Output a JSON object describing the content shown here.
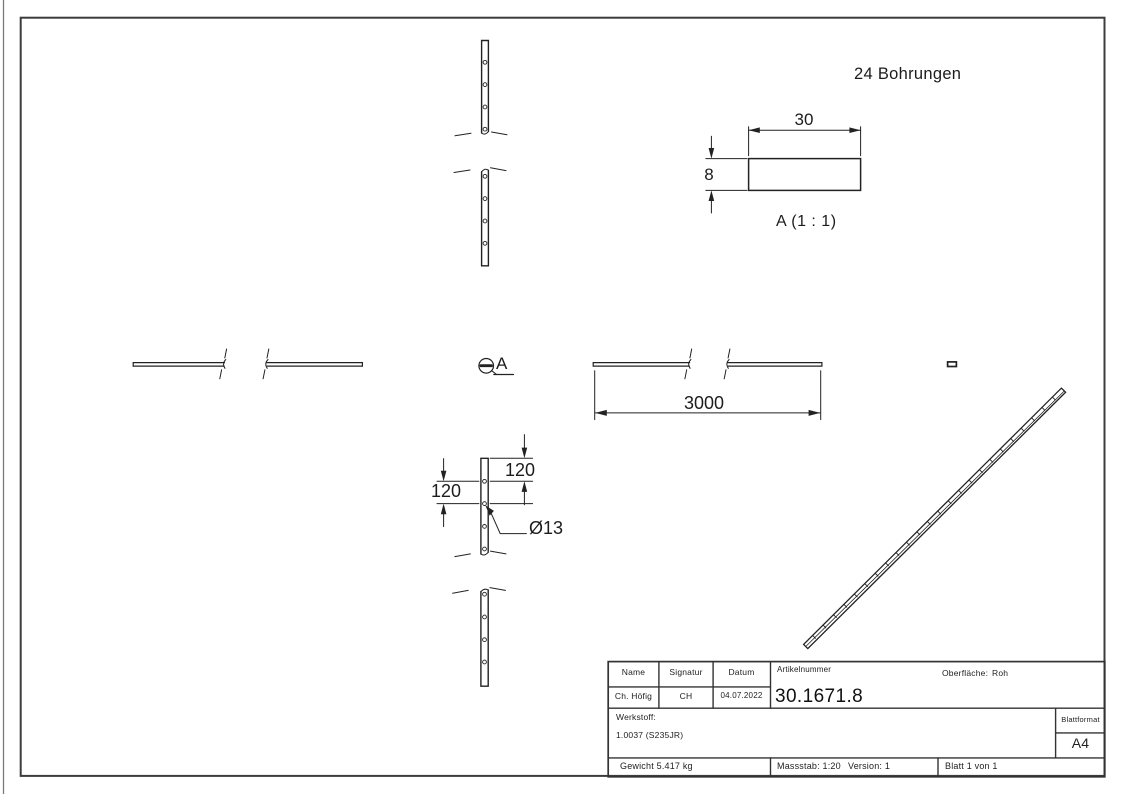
{
  "sheet": {
    "note_holes": "24 Bohrungen",
    "detail_title": "A (1 : 1)",
    "detail_callout_letter": "A",
    "dims": {
      "length": "3000",
      "detail_width": "30",
      "detail_thickness": "8",
      "hole_spacing_upper": "120",
      "hole_spacing_lower": "120",
      "hole_diameter": "Ø13"
    },
    "isometric": {
      "hole_count": 24
    }
  },
  "title_block": {
    "headers": {
      "name": "Name",
      "signatur": "Signatur",
      "datum": "Datum"
    },
    "name": "Ch. Höfig",
    "signatur": "CH",
    "datum": "04.07.2022",
    "artikelnummer_label": "Artikelnummer",
    "artikelnummer": "30.1671.8",
    "oberflaeche_label": "Oberfläche:",
    "oberflaeche_value": "Roh",
    "werkstoff_label": "Werkstoff:",
    "werkstoff_value": "1.0037 (S235JR)",
    "blattformat_label": "Blattformat",
    "blattformat_value": "A4",
    "gewicht": "Gewicht 5.417 kg",
    "massstab": "Massstab: 1:20",
    "version": "Version: 1",
    "blatt": "Blatt 1 von 1"
  }
}
